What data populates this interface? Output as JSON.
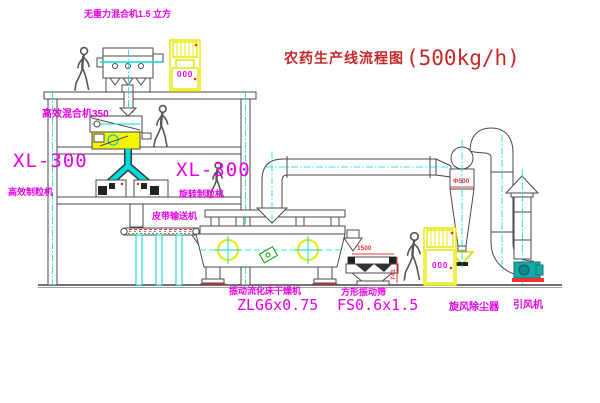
{
  "diagram": {
    "title": {
      "name_cn": "农药生产线流程图",
      "capacity": "(500kg/h)"
    },
    "labels": {
      "gravity_free_mixer": "无重力混合机1.5 立方",
      "high_eff_mixer": "高效混合机350",
      "granulator_left": {
        "model": "XL-300",
        "name": "高效制粒机"
      },
      "granulator_right": {
        "model": "XL-300",
        "name": "旋转制粒机"
      },
      "belt_conveyor": "皮带输送机",
      "fluid_bed_dryer": {
        "name": "振动流化床干燥机",
        "model": "ZLG6x0.75"
      },
      "square_screen": {
        "name": "方形振动筛",
        "model": "FS0.6x1.5"
      },
      "cyclone": "旋风除尘器",
      "induced_draft_fan": "引风机"
    },
    "dimensions": {
      "cyclone_diameter": "Φ500",
      "screen_length": "1500",
      "screen_height": "741"
    },
    "cabinet_indicator": "000",
    "colors": {
      "label_magenta": "#e800e8",
      "title_red": "#c62828",
      "machine_yellow": "#f0f000",
      "centerline_cyan": "#00dcdc",
      "line": "#4a4a4a",
      "fan_teal": "#1aa7a7",
      "dimension_red": "#ee3333"
    }
  }
}
